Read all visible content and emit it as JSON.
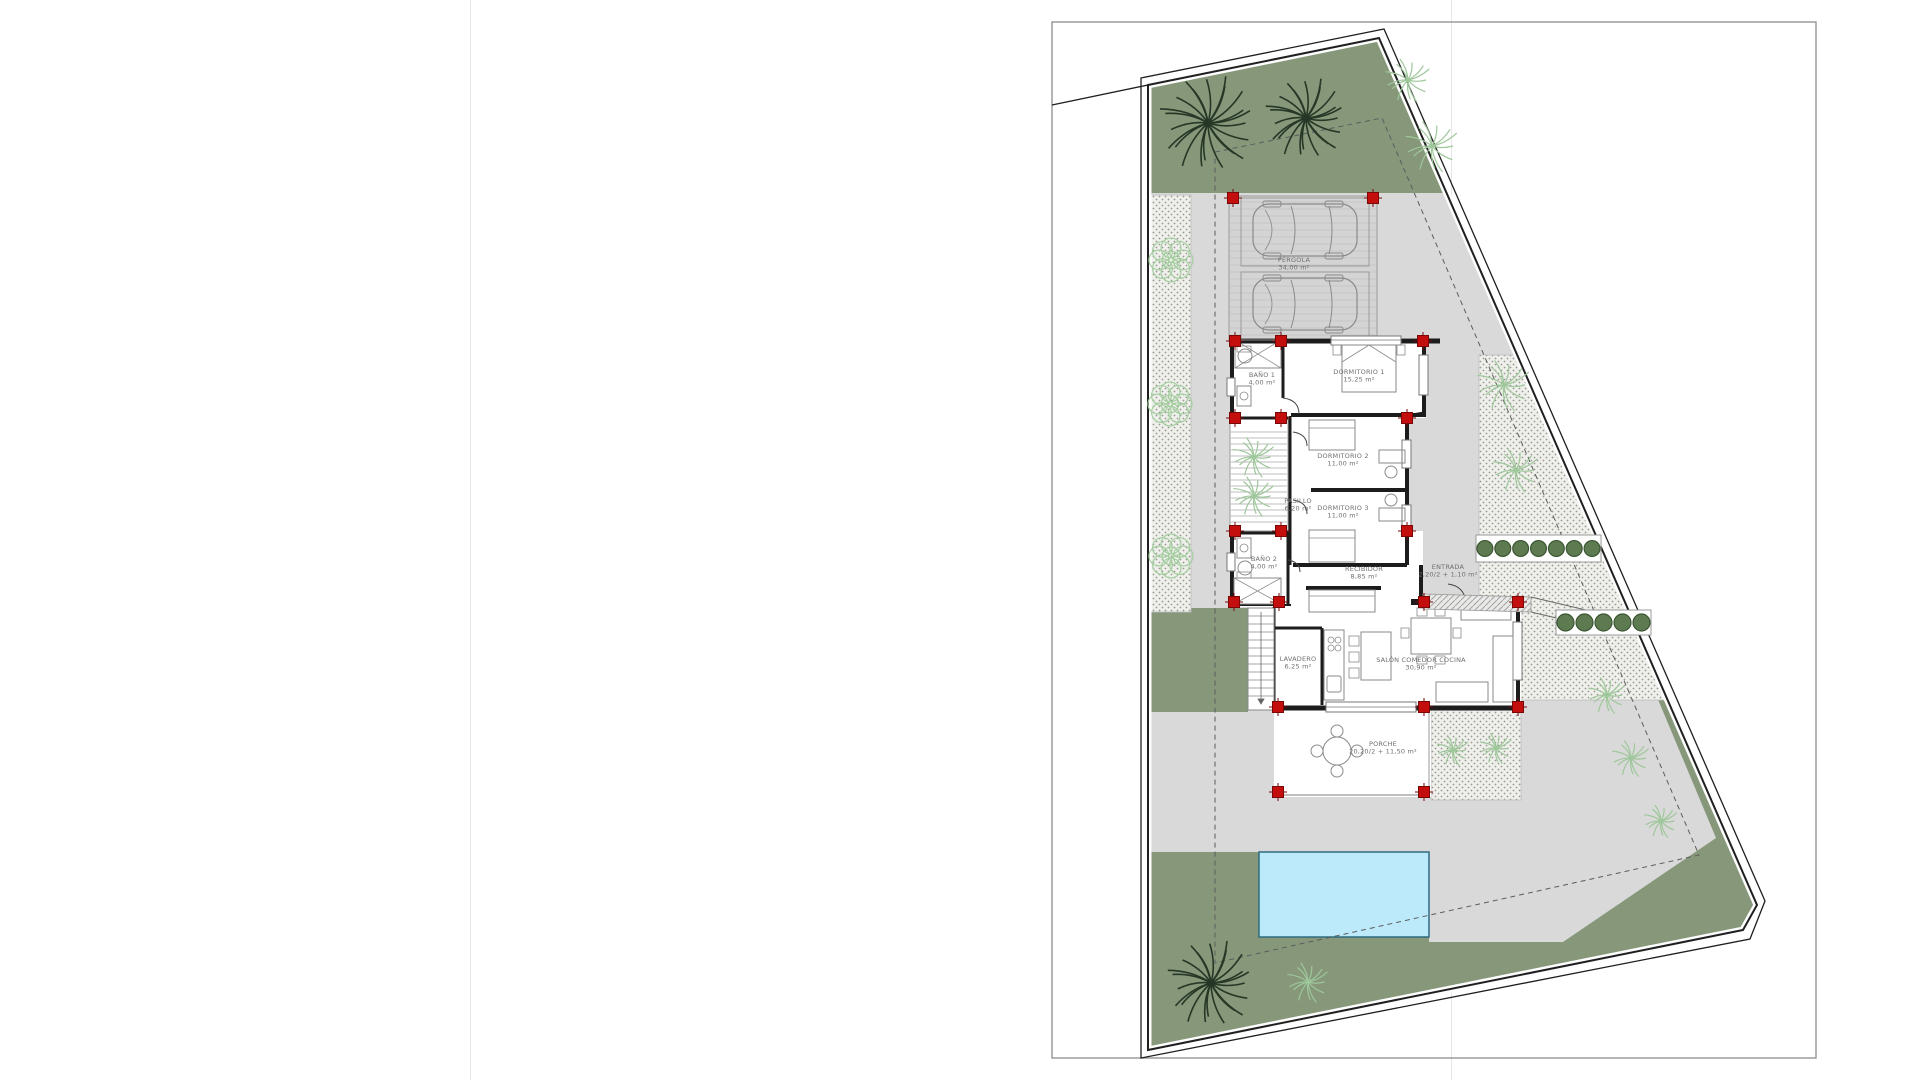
{
  "sheet": {
    "description": "Villa site / floor plan drawing",
    "rooms": [
      {
        "id": "pergola",
        "name": "PÉRGOLA",
        "area": "34,00 m²",
        "x": 823,
        "y": 262
      },
      {
        "id": "bano1",
        "name": "BAÑO 1",
        "area": "4,00 m²",
        "x": 791,
        "y": 377
      },
      {
        "id": "dormitorio1",
        "name": "DORMITORIO 1",
        "area": "15,25 m²",
        "x": 888,
        "y": 374
      },
      {
        "id": "dormitorio2",
        "name": "DORMITORIO 2",
        "area": "11,00 m²",
        "x": 872,
        "y": 458
      },
      {
        "id": "dormitorio3",
        "name": "DORMITORIO 3",
        "area": "11,00 m²",
        "x": 872,
        "y": 510
      },
      {
        "id": "pasillo",
        "name": "PASILLO",
        "area": "6,20 m²",
        "x": 827,
        "y": 503
      },
      {
        "id": "bano2",
        "name": "BAÑO 2",
        "area": "4,00 m²",
        "x": 793,
        "y": 561
      },
      {
        "id": "recibidor",
        "name": "RECIBIDOR",
        "area": "8,85 m²",
        "x": 893,
        "y": 571
      },
      {
        "id": "entrada",
        "name": "ENTRADA",
        "area": "2,20/2 + 1,10 m²",
        "x": 977,
        "y": 569
      },
      {
        "id": "lavadero",
        "name": "LAVADERO",
        "area": "6,25 m²",
        "x": 827,
        "y": 661
      },
      {
        "id": "salon",
        "name": "SALÓN COMEDOR COCINA",
        "area": "30,90 m²",
        "x": 950,
        "y": 662
      },
      {
        "id": "porche",
        "name": "PORCHE",
        "area": "20,20/2 + 11,50 m²",
        "x": 912,
        "y": 746
      }
    ],
    "colors": {
      "garden_green": "#86977a",
      "paving_gray": "#d9d9d9",
      "gravel_base": "#efefec",
      "gravel_dot": "#999990",
      "pool_water": "#bceafb",
      "pool_edge": "#2e6b80",
      "column_red": "#c40d0d",
      "column_red_dark": "#7a0606",
      "wall_black": "#1c1c1c",
      "furniture_gray": "#8a8a8a",
      "label_gray": "#6f6f6f",
      "hedge_green": "#5e7a50",
      "hedge_edge": "#3a5531",
      "palm_dark": "#263726",
      "palm_light": "#9ec79a",
      "bush_light": "#a5cfa0"
    },
    "site": {
      "columns": [
        [
          762,
          198
        ],
        [
          902,
          198
        ],
        [
          764,
          341
        ],
        [
          810,
          341
        ],
        [
          952,
          341
        ],
        [
          764,
          418
        ],
        [
          810,
          418
        ],
        [
          936,
          418
        ],
        [
          764,
          531
        ],
        [
          810,
          531
        ],
        [
          936,
          531
        ],
        [
          763,
          602
        ],
        [
          808,
          602
        ],
        [
          953,
          602
        ],
        [
          1047,
          602
        ],
        [
          807,
          707
        ],
        [
          953,
          707
        ],
        [
          1047,
          707
        ],
        [
          807,
          792
        ],
        [
          953,
          792
        ]
      ],
      "trees": [
        {
          "type": "palm-dark",
          "x": 737,
          "y": 123,
          "r": 50
        },
        {
          "type": "palm-dark",
          "x": 835,
          "y": 118,
          "r": 42
        },
        {
          "type": "palm-dark",
          "x": 740,
          "y": 983,
          "r": 45
        },
        {
          "type": "palm-light",
          "x": 937,
          "y": 80,
          "r": 24
        },
        {
          "type": "palm-light",
          "x": 961,
          "y": 146,
          "r": 28
        },
        {
          "type": "palm-light",
          "x": 1033,
          "y": 385,
          "r": 28
        },
        {
          "type": "palm-light",
          "x": 1045,
          "y": 470,
          "r": 24
        },
        {
          "type": "palm-light",
          "x": 783,
          "y": 457,
          "r": 22
        },
        {
          "type": "palm-light",
          "x": 783,
          "y": 496,
          "r": 22
        },
        {
          "type": "palm-light",
          "x": 982,
          "y": 750,
          "r": 17
        },
        {
          "type": "palm-light",
          "x": 1025,
          "y": 748,
          "r": 17
        },
        {
          "type": "palm-light",
          "x": 1136,
          "y": 695,
          "r": 20
        },
        {
          "type": "palm-light",
          "x": 1160,
          "y": 758,
          "r": 20
        },
        {
          "type": "palm-light",
          "x": 1190,
          "y": 821,
          "r": 18
        },
        {
          "type": "palm-light",
          "x": 837,
          "y": 982,
          "r": 22
        },
        {
          "type": "bush",
          "x": 700,
          "y": 260,
          "r": 22
        },
        {
          "type": "bush",
          "x": 699,
          "y": 404,
          "r": 22
        },
        {
          "type": "bush",
          "x": 700,
          "y": 556,
          "r": 22
        }
      ],
      "hedges": [
        {
          "x": 1005,
          "y": 535,
          "w": 125,
          "h": 27,
          "count": 7
        },
        {
          "x": 1085,
          "y": 610,
          "w": 95,
          "h": 25,
          "count": 5
        }
      ],
      "parking_cars": 2
    }
  }
}
